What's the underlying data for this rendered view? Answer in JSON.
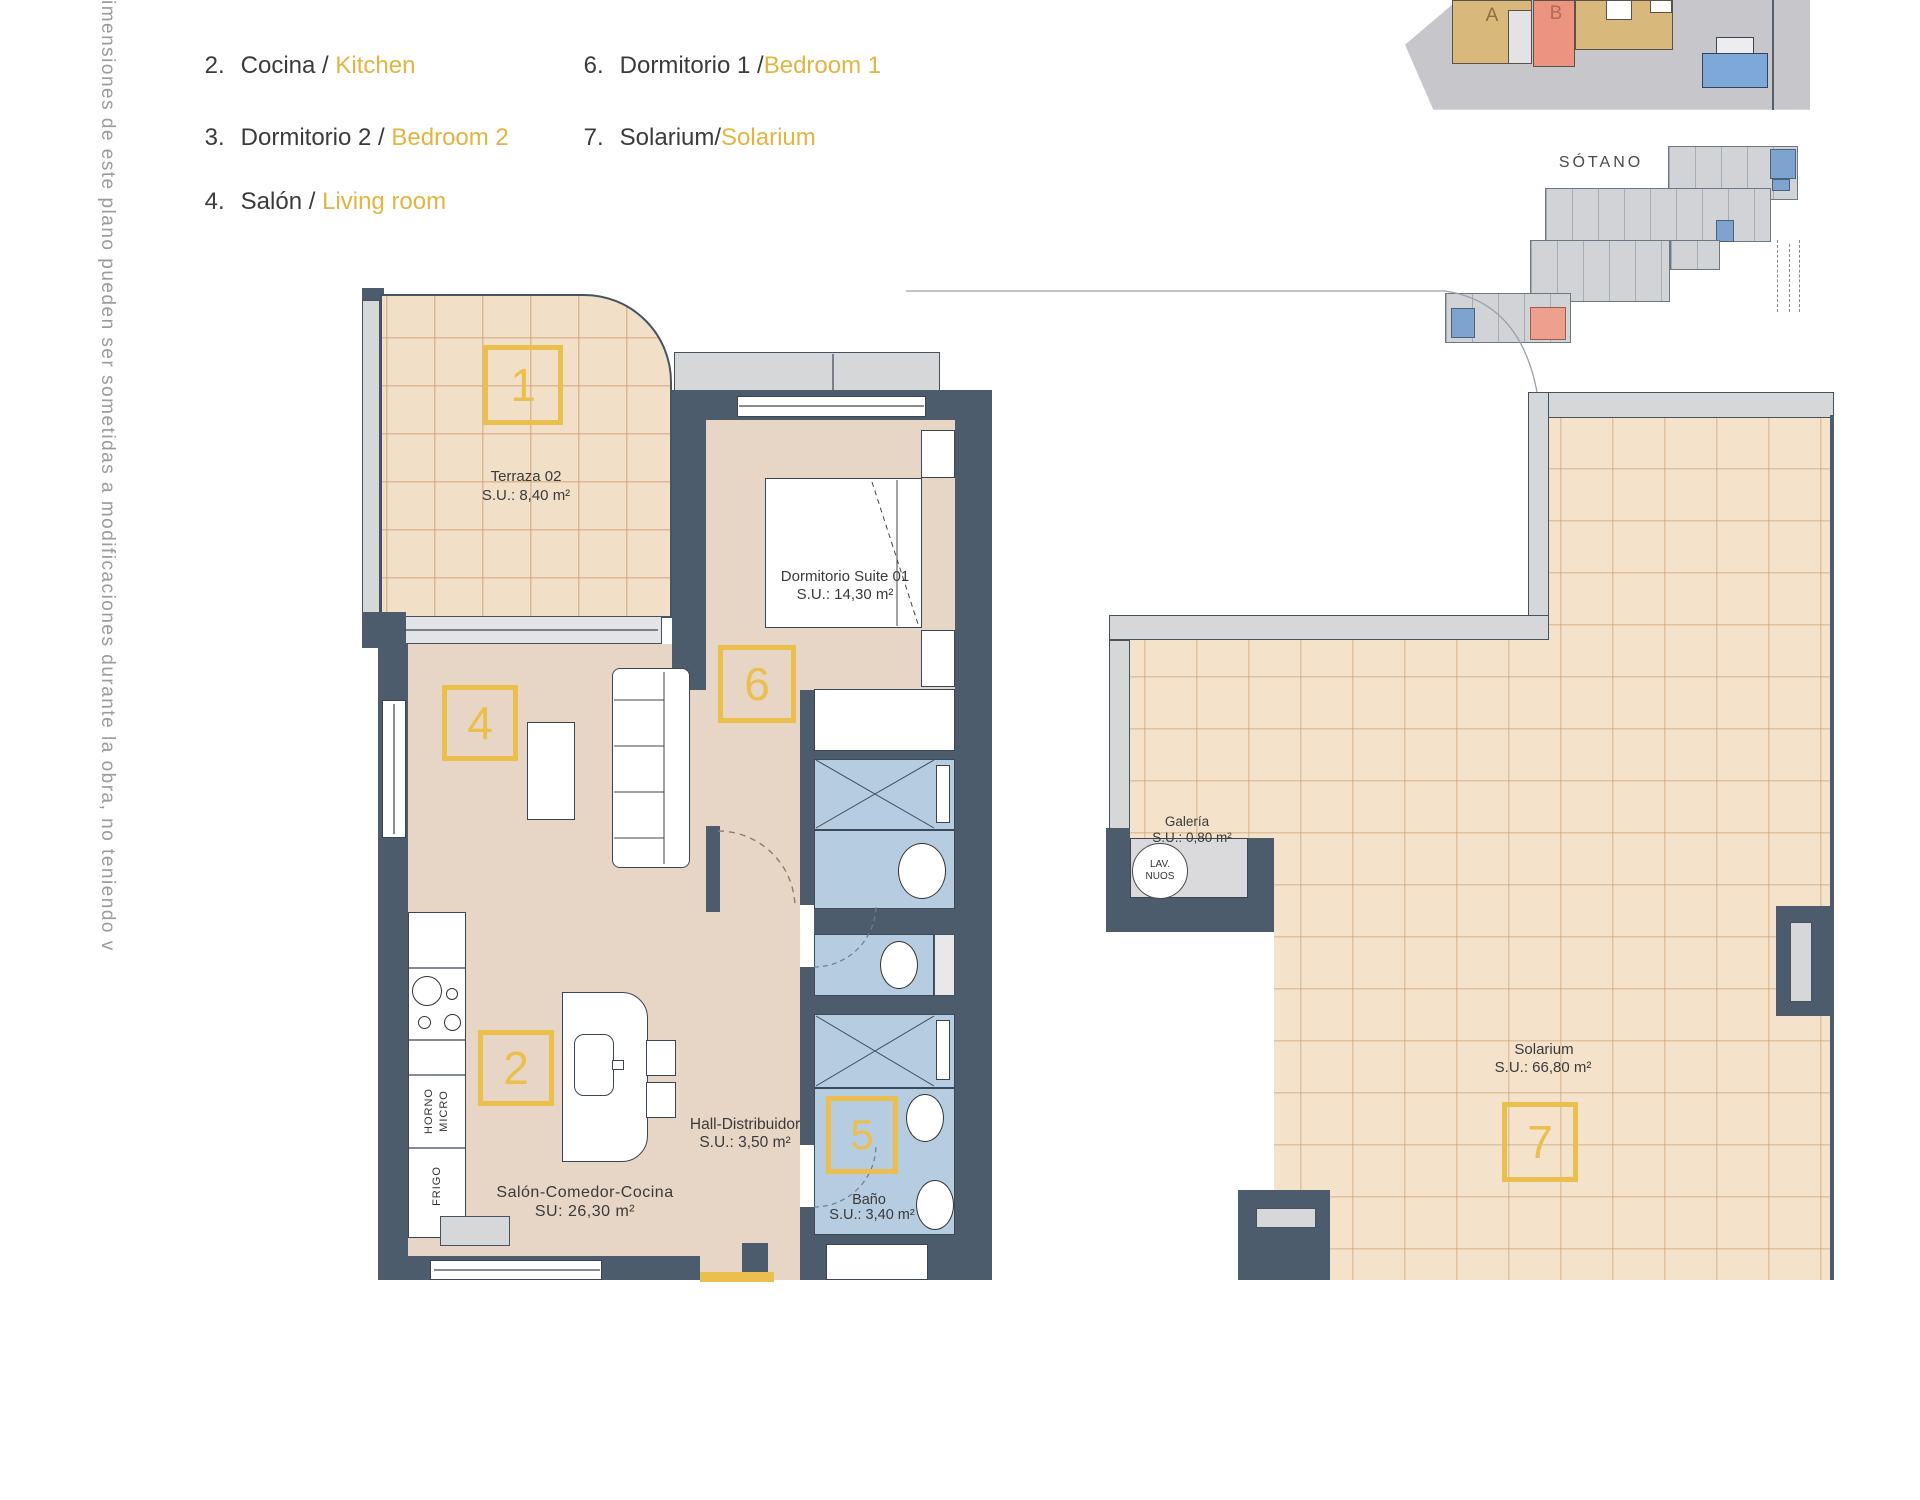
{
  "legend": {
    "items": [
      {
        "num": "2.",
        "es": "Cocina / ",
        "en": "Kitchen"
      },
      {
        "num": "3.",
        "es": "Dormitorio 2 / ",
        "en": "Bedroom 2"
      },
      {
        "num": "4.",
        "es": "Salón / ",
        "en": "Living room"
      },
      {
        "num": "6.",
        "es": "Dormitorio 1 /",
        "en": "Bedroom 1"
      },
      {
        "num": "7.",
        "es": "Solarium/",
        "en": "Solarium"
      }
    ]
  },
  "disclaimer": "imensiones de este plano pueden ser sometidas a modificaciones durante la obra, no teniendo v",
  "overview": {
    "building_a": "A",
    "building_b": "B",
    "basement_title": "SÓTANO"
  },
  "rooms": {
    "terraza": {
      "tag": "1",
      "name": "Terraza 02",
      "area": "S.U.: 8,40 m²"
    },
    "salon": {
      "tag": "4",
      "name": "Salón-Comedor-Cocina",
      "area": "SU: 26,30 m²"
    },
    "cocina": {
      "tag": "2"
    },
    "dormitorio_suite": {
      "tag": "6",
      "name": "Dormitorio Suite 01",
      "area": "S.U.: 14,30 m²"
    },
    "hall": {
      "name": "Hall-Distribuidor",
      "area": "S.U.: 3,50 m²"
    },
    "bano": {
      "tag": "5",
      "name": "Baño",
      "area": "S.U.: 3,40 m²"
    },
    "galeria": {
      "name": "Galería",
      "area": "S.U.: 0,80 m²",
      "appliance_line1": "LAV.",
      "appliance_line2": "NUOS"
    },
    "solarium": {
      "tag": "7",
      "name": "Solarium",
      "area": "S.U.: 66,80 m²"
    }
  },
  "kitchen": {
    "horno": "HORNO",
    "micro": "MICRO",
    "frigo": "FRIGO"
  },
  "colors": {
    "wall": "#4d5c6d",
    "floor": "#e7d5c6",
    "terrace_tile": "#f2dfc8",
    "bath": "#b6cce0",
    "accent_yellow": "#eabf4e",
    "legend_en_text": "#e2b440",
    "site_building_a": "#d9b87c",
    "site_building_b": "#ec9480",
    "pool": "#7ea8d8"
  }
}
